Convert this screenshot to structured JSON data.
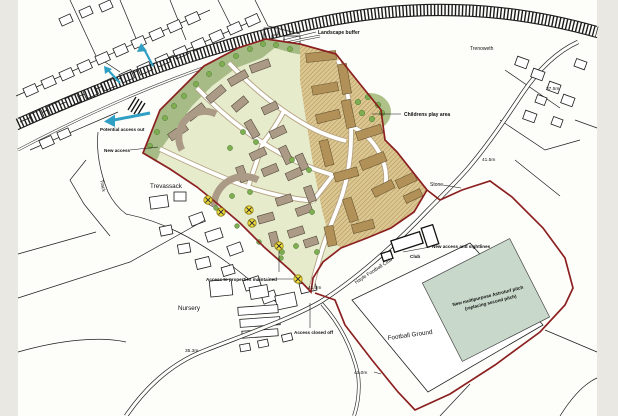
{
  "map": {
    "type": "development-site-plan",
    "annotations": {
      "landscape_buffer": "Landscape buffer",
      "childrens_play_area": "Childrens play area",
      "potential_access": "Potential access out",
      "new_access": "New access",
      "access_maintained": "Access to properties maintained",
      "access_closed": "Access closed off",
      "new_access_sightlines": "New access and sightlines",
      "astroturf_line1": "New multipurpose Astroturf pitch",
      "astroturf_line2": "(replacing second pitch)"
    },
    "places": {
      "trevassack": "Trevassack",
      "trenoweth": "Trenoweth",
      "nursery": "Nursery",
      "stone": "Stone",
      "track": "Track",
      "club": "Club",
      "hayle_football_club": "Hayle Football Club",
      "football_ground": "Football Ground"
    },
    "elevations": {
      "e1": "37.5m",
      "e2": "41.5m",
      "e3": "41.0m",
      "e4": "35.3m",
      "e5": "43.0m"
    },
    "colors": {
      "site_boundary": "#8b2020",
      "landscape_buffer": "#a6bb85",
      "parcel": "#e6ebcc",
      "parcel_east_base": "#dbc793",
      "building_west": "#ab9a86",
      "building_east": "#b19157",
      "tree": "#7fae52",
      "road_casing": "#b5a383",
      "astroturf_pitch": "#c8d8ca",
      "arrow_blue": "#2f9fc4",
      "access_marker": "#f2df3e",
      "os_line": "#1d1d1d"
    }
  }
}
